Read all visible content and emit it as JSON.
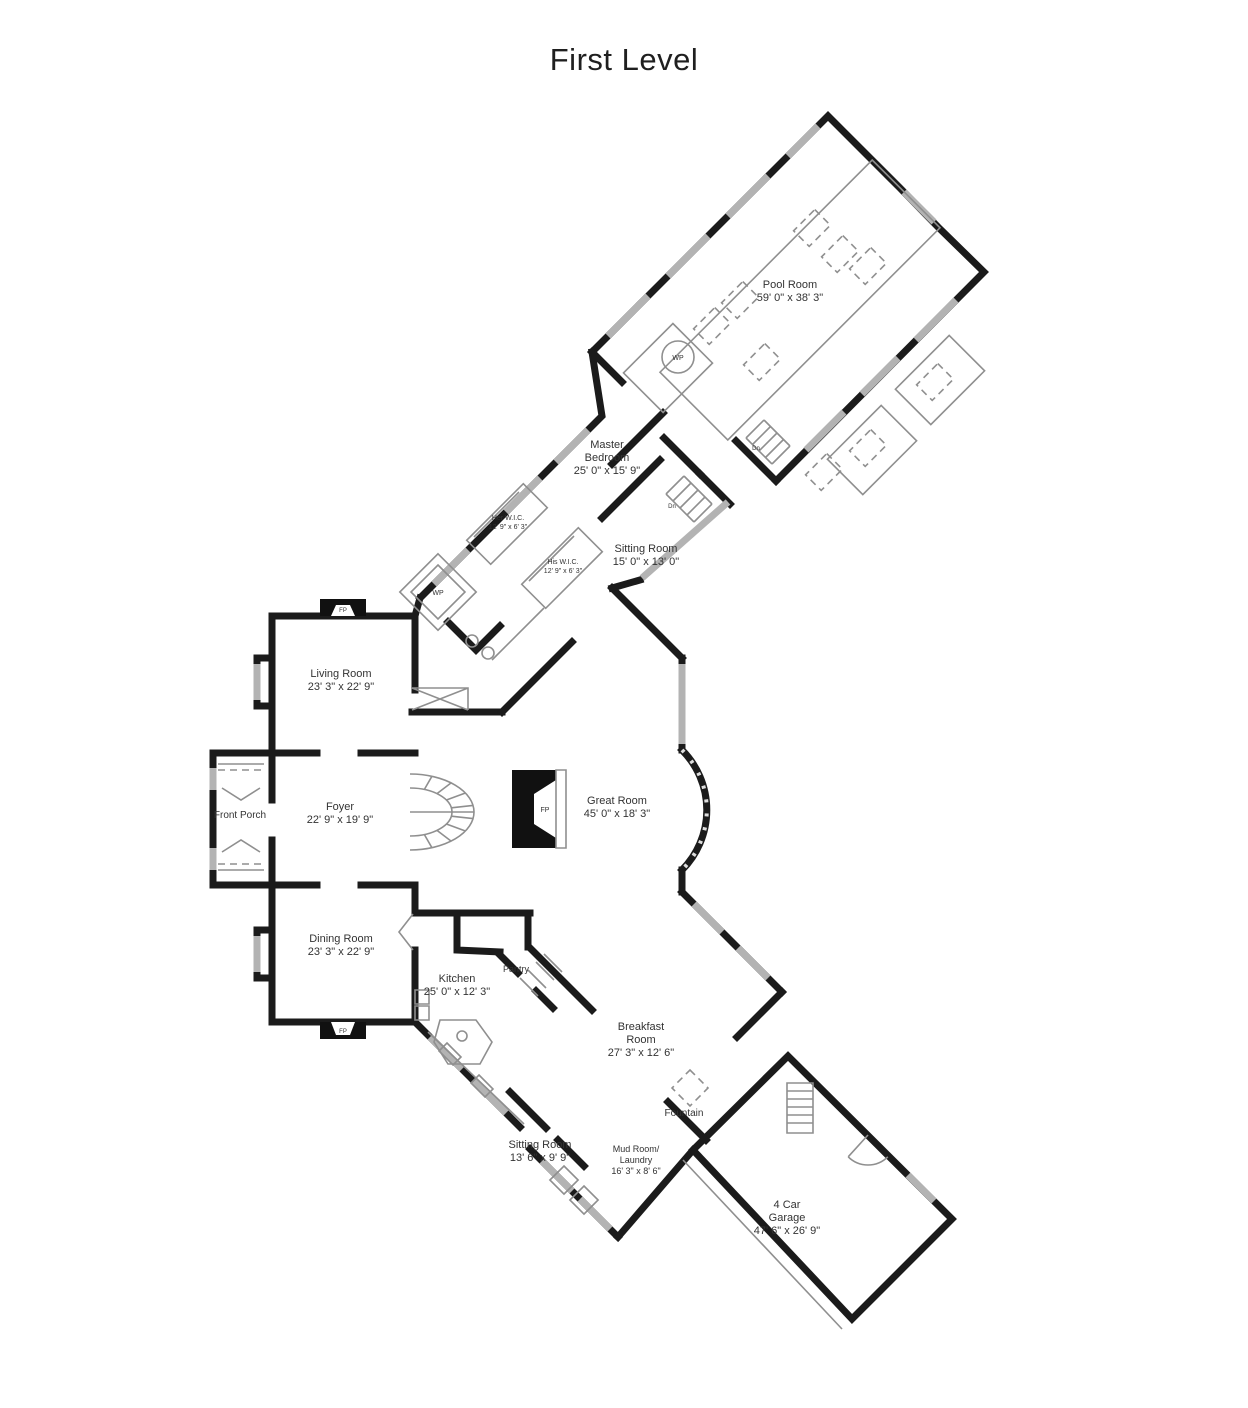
{
  "title": "First Level",
  "colors": {
    "wall": "#1b1b1b",
    "thin": "#8f8f8f",
    "window": "#b3b3b3",
    "label": "#333333",
    "background": "#ffffff"
  },
  "rooms": [
    {
      "name": "Pool Room",
      "dimensions": "59' 0\" x 38' 3\""
    },
    {
      "name": "Master Bedroom",
      "dimensions": "25' 0\" x 15' 9\""
    },
    {
      "name": "Her W.I.C.",
      "dimensions": "12' 9\" x 6' 3\""
    },
    {
      "name": "His W.I.C.",
      "dimensions": "12' 9\" x 6' 3\""
    },
    {
      "name": "Sitting Room",
      "dimensions": "15' 0\" x 13' 0\""
    },
    {
      "name": "Living Room",
      "dimensions": "23' 3\" x 22' 9\""
    },
    {
      "name": "Front Porch",
      "dimensions": ""
    },
    {
      "name": "Foyer",
      "dimensions": "22' 9\" x 19' 9\""
    },
    {
      "name": "Great Room",
      "dimensions": "45' 0\" x 18' 3\""
    },
    {
      "name": "Dining Room",
      "dimensions": "23' 3\" x 22' 9\""
    },
    {
      "name": "Kitchen",
      "dimensions": "25' 0\" x 12' 3\""
    },
    {
      "name": "Pantry",
      "dimensions": ""
    },
    {
      "name": "Breakfast Room",
      "dimensions": "27' 3\" x 12' 6\""
    },
    {
      "name": "Fountain",
      "dimensions": ""
    },
    {
      "name": "Sitting Room (rear)",
      "dimensions": "13' 6\" x 9' 9\""
    },
    {
      "name": "Mud Room/Laundry",
      "dimensions": "16' 3\" x 8' 6\""
    },
    {
      "name": "4 Car Garage",
      "dimensions": "47' 6\" x 26' 9\""
    }
  ],
  "labels": [
    {
      "name": "room-label-pool-room",
      "lines": [
        "Pool Room",
        "59' 0\" x 38' 3\""
      ],
      "x": 790,
      "y": 288,
      "size": 11
    },
    {
      "name": "room-label-master-bedroom",
      "lines": [
        "Master",
        "Bedroom",
        "25' 0\" x 15' 9\""
      ],
      "x": 607,
      "y": 448,
      "size": 11
    },
    {
      "name": "room-label-her-wic",
      "lines": [
        "Her W.I.C.",
        "12' 9\" x 6' 3\""
      ],
      "x": 508,
      "y": 520,
      "size": 7
    },
    {
      "name": "room-label-his-wic",
      "lines": [
        "His W.I.C.",
        "12' 9\" x 6' 3\""
      ],
      "x": 563,
      "y": 564,
      "size": 7
    },
    {
      "name": "room-label-sitting-room-master",
      "lines": [
        "Sitting Room",
        "15' 0\" x 13' 0\""
      ],
      "x": 646,
      "y": 552,
      "size": 11
    },
    {
      "name": "room-label-living-room",
      "lines": [
        "Living Room",
        "23' 3\" x 22' 9\""
      ],
      "x": 341,
      "y": 677,
      "size": 11
    },
    {
      "name": "room-label-front-porch",
      "lines": [
        "Front Porch"
      ],
      "x": 240,
      "y": 818,
      "size": 10
    },
    {
      "name": "room-label-foyer",
      "lines": [
        "Foyer",
        "22' 9\" x 19' 9\""
      ],
      "x": 340,
      "y": 810,
      "size": 11
    },
    {
      "name": "room-label-great-room",
      "lines": [
        "Great Room",
        "45' 0\" x 18' 3\""
      ],
      "x": 617,
      "y": 804,
      "size": 11
    },
    {
      "name": "room-label-dining-room",
      "lines": [
        "Dining Room",
        "23' 3\" x 22' 9\""
      ],
      "x": 341,
      "y": 942,
      "size": 11
    },
    {
      "name": "room-label-kitchen",
      "lines": [
        "Kitchen",
        "25' 0\" x 12' 3\""
      ],
      "x": 457,
      "y": 982,
      "size": 11
    },
    {
      "name": "room-label-pantry",
      "lines": [
        "Pantry"
      ],
      "x": 516,
      "y": 972,
      "size": 9
    },
    {
      "name": "room-label-breakfast-room",
      "lines": [
        "Breakfast",
        "Room",
        "27' 3\" x 12' 6\""
      ],
      "x": 641,
      "y": 1030,
      "size": 11
    },
    {
      "name": "room-label-fountain",
      "lines": [
        "Fountain"
      ],
      "x": 684,
      "y": 1116,
      "size": 10
    },
    {
      "name": "room-label-sitting-room-rear",
      "lines": [
        "Sitting Room",
        "13' 6\" x 9' 9\""
      ],
      "x": 540,
      "y": 1148,
      "size": 11
    },
    {
      "name": "room-label-mud-room",
      "lines": [
        "Mud Room/",
        "Laundry",
        "16' 3\" x 8' 6\""
      ],
      "x": 636,
      "y": 1152,
      "size": 9
    },
    {
      "name": "room-label-garage",
      "lines": [
        "4 Car",
        "Garage",
        "47' 6\" x 26' 9\""
      ],
      "x": 787,
      "y": 1208,
      "size": 11
    },
    {
      "name": "fixture-label-whirlpool-pool",
      "lines": [
        "WP"
      ],
      "x": 678,
      "y": 360,
      "size": 7
    },
    {
      "name": "fixture-label-whirlpool-bath",
      "lines": [
        "WP"
      ],
      "x": 438,
      "y": 595,
      "size": 7
    },
    {
      "name": "fixture-label-fireplace-living",
      "lines": [
        "FP"
      ],
      "x": 343,
      "y": 612,
      "size": 6
    },
    {
      "name": "fixture-label-fireplace-great",
      "lines": [
        "FP"
      ],
      "x": 545,
      "y": 812,
      "size": 7
    },
    {
      "name": "fixture-label-fireplace-dining",
      "lines": [
        "FP"
      ],
      "x": 343,
      "y": 1033,
      "size": 6
    },
    {
      "name": "stair-label-dn-pool",
      "lines": [
        "Dn"
      ],
      "x": 756,
      "y": 450,
      "size": 6
    },
    {
      "name": "stair-label-dn-hall",
      "lines": [
        "Dn"
      ],
      "x": 672,
      "y": 508,
      "size": 6
    }
  ],
  "geometry": {
    "layers": [
      {
        "name": "exterior-and-interior-walls",
        "cls": "wall",
        "paths": [
          "M272,616 L272,800 M272,840 L272,1022",
          "M272,616 L415,616",
          "M415,616 L415,690",
          "M272,753 L317,753 M361,753 L415,753",
          "M268,753 L213,753 L213,885 L268,885",
          "M272,885 L317,885 M361,885 L415,885",
          "M415,950 L415,1022 L272,1022",
          "M272,658 L257,658 L257,706 L272,706",
          "M272,930 L257,930 L257,978 L272,978",
          "M415,885 L415,912",
          "M412,712 L502,712",
          "M502,712 L572,642",
          "M612,588 L682,658",
          "M682,658 L682,750 M682,870 L682,892",
          "M682,750 A85,85 0 0 1 682,870",
          "M682,892 L782,992",
          "M420,598 L415,616",
          "M420,598 L602,416 L592,352",
          "M592,352 L828,116 L900,188 L938,227 L984,272 L776,481",
          "M776,481 L736,441",
          "M664,438 L700,474",
          "M700,474 L730,504",
          "M640,580 L612,588",
          "M602,518 L660,460",
          "M663,413 L612,464",
          "M592,352 L622,382",
          "M448,622 L476,650 L500,626",
          "M415,913 L530,913",
          "M457,913 L457,950 L500,952",
          "M528,913 L528,947",
          "M530,948 L592,1010",
          "M500,955 L518,973 M536,991 L553,1008",
          "M415,1022 L520,1127",
          "M530,1149 L618,1237",
          "M618,1237 L693,1150",
          "M693,1150 L788,1056 L952,1219 L852,1319 Z",
          "M510,1092 L546,1128 M558,1140 L584,1166",
          "M668,1102 L706,1140",
          "M782,992 L737,1037"
        ]
      },
      {
        "name": "window-segments",
        "cls": "window",
        "paths": [
          "M213,768 L213,790 M213,848 L213,870",
          "M257,664 L257,700",
          "M257,936 L257,972",
          "M434,584 L468,550 M506,512 L540,478 M556,462 L588,430",
          "M608,336 L648,296 M668,276 L708,236 M728,216 L768,176 M788,156 L818,126",
          "M904,192 L934,222",
          "M956,300 L916,340 M898,358 L862,394 M844,412 L806,450",
          "M682,664 L682,744",
          "M694,904 L722,932 M738,948 L768,978",
          "M430,1037 L462,1069 M474,1081 L506,1113",
          "M542,1161 L572,1191 M580,1199 L610,1229",
          "M728,502 L642,578",
          "M908,1175 L934,1201"
        ]
      },
      {
        "name": "bay-window-mullions",
        "cls": "wmull",
        "paths": [
          "M682,750 A85,85 0 0 1 682,870"
        ]
      },
      {
        "name": "fireplace-masonry",
        "cls": "fillblack",
        "paths": [
          "M320,599 L366,599 L366,616 L320,616 Z",
          "M320,1022 L366,1022 L366,1039 L320,1039 Z",
          "M512,770 L556,770 L556,848 L512,848 Z"
        ]
      },
      {
        "name": "fireplace-fireboxes",
        "cls": "fillwhite",
        "paths": [
          "M331,616 L336,605 L350,605 L355,616 Z",
          "M331,1022 L336,1035 L350,1035 L355,1022 Z",
          "M556,780 L534,794 L534,824 L556,838 Z"
        ]
      },
      {
        "name": "fixtures-and-fittings",
        "cls": "thin",
        "paths": [
          "M872.2,160 L940,227.8 L727.8,440 L660,372.2 Z",
          "M949.2,335.4 L984.6,370.8 L930.8,424.6 L895.4,389.2 Z",
          "M881.2,405.4 L916.6,440.8 L862.8,494.6 L827.4,459.2 Z",
          "M672.9,323.5 L712.5,363.1 L663.1,412.5 L623.5,372.9 Z",
          "M662,357 A16,16 0 1 0 694,357 A16,16 0 1 0 662,357",
          "M666,494 L694,522 M684,476 L712,504",
          "M666,494 L684,476 M673,501 L691,483 M680,508 L698,490 M687,515 L705,497 M694,522 L712,504",
          "M746,438 L772,464 M764,420 L790,446",
          "M746,438 L764,420 M752.5,444.5 L770.5,426.5 M759,451 L777,433 M765.5,457.5 L783.5,439.5 M772,464 L790,446",
          "M438,553.8 L476.2,592 L438,630.2 L399.8,592 Z M438,565 L465,592 L438,619 L411,592 Z",
          "M466,641 A6,6 0 1 0 478,641 A6,6 0 1 0 466,641 M482,653 A6,6 0 1 0 494,653 A6,6 0 1 0 482,653",
          "M492,660 L544,608",
          "M523.3,483.7 L547.3,507.7 L490.7,564.3 L466.7,540.3 Z M519,492 L474,537",
          "M578.3,527.7 L602.3,551.7 L545.7,608.3 L521.7,584.3 Z M574,536 L529,581",
          "M412,688 L468,688 L468,710 M412,688 L468,710 M468,688 L412,710",
          "M410,774 A64,38 0 0 1 474,812 A64,38 0 0 1 410,850 M410,788 A42,24 0 0 1 452,812 A42,24 0 0 1 410,836 M410,812 L474,812",
          "M431.9,776.3 L424.4,789.4 M451.1,782.9 L437,793.6 M465.4,793 L446.4,800 M473,805.4 L451.4,807.8 M473,818.6 L451.4,816.2 M465.4,831 L446.4,824 M451.1,841.1 L437,830.4 M431.9,847.7 L424.4,834.6",
          "M218,764 L264,764 M218,870 L264,870 M222,788 L241,800 L260,788 M222,852 L241,840 L260,852",
          "M556,770 L566,770 L566,848 L556,848 Z",
          "M520,978 L538,996 M528,970 L546,988 M536,962 L554,980 M544,954 L562,972",
          "M428,1032 L524,1124",
          "M415,990 L429,990 L429,1004 L415,1004 Z M415,1006 L429,1006 L429,1020 L415,1020 Z",
          "M440,1020 L476,1020 L492,1042 L480,1064 L448,1064 L434,1042 Z M457,1036 A5,5 0 1 0 467,1036 A5,5 0 1 0 457,1036",
          "M447,1043 L461,1057 L453,1065 L439,1051 Z M479,1075 L493,1089 L485,1097 L471,1083 Z",
          "M413,914 L399,932 L413,950",
          "M584,1186 L598.1,1200 L584,1214.1 L569.9,1200 Z M564,1166 L578.1,1180 L564,1194.1 L549.9,1180 Z",
          "M787,1083 L813,1083 L813,1133 L787,1133 Z M787,1091 L813,1091 M787,1099 L813,1099 M787,1107 L813,1107 M787,1115 L813,1115 M787,1123 L813,1123",
          "M868,1135 L848.2,1156.8 M848.2,1156.8 A28,28 0 0 0 887.8,1156.8",
          "M683,1160 L842,1329"
        ]
      },
      {
        "name": "furniture-dashed",
        "cls": "dashed",
        "paths": [
          "M814.8,209.6 L830.4,225.2 L809.2,246.4 L793.6,230.8 Z",
          "M842.8,235.6 L858.4,251.2 L837.2,272.4 L821.6,256.8 Z",
          "M870.8,247.6 L886.4,263.2 L865.2,284.4 L849.6,268.8 Z",
          "M714.8,307.6 L730.4,323.2 L709.2,344.4 L693.6,328.8 Z",
          "M742.8,281.6 L758.4,297.2 L737.2,318.4 L721.6,302.8 Z",
          "M764.8,343.6 L780.4,359.2 L759.2,380.4 L743.6,364.8 Z",
          "M937.8,363.6 L953.4,379.2 L932.2,400.4 L916.6,384.8 Z",
          "M870.8,429.6 L886.4,445.2 L865.2,466.4 L849.6,450.8 Z",
          "M826.8,453.6 L842.4,469.2 L821.2,490.4 L805.6,474.8 Z",
          "M690,1070 L708,1088 L690,1106 L672,1088 Z",
          "M218,770 L264,770 M218,864 L264,864"
        ]
      }
    ]
  }
}
